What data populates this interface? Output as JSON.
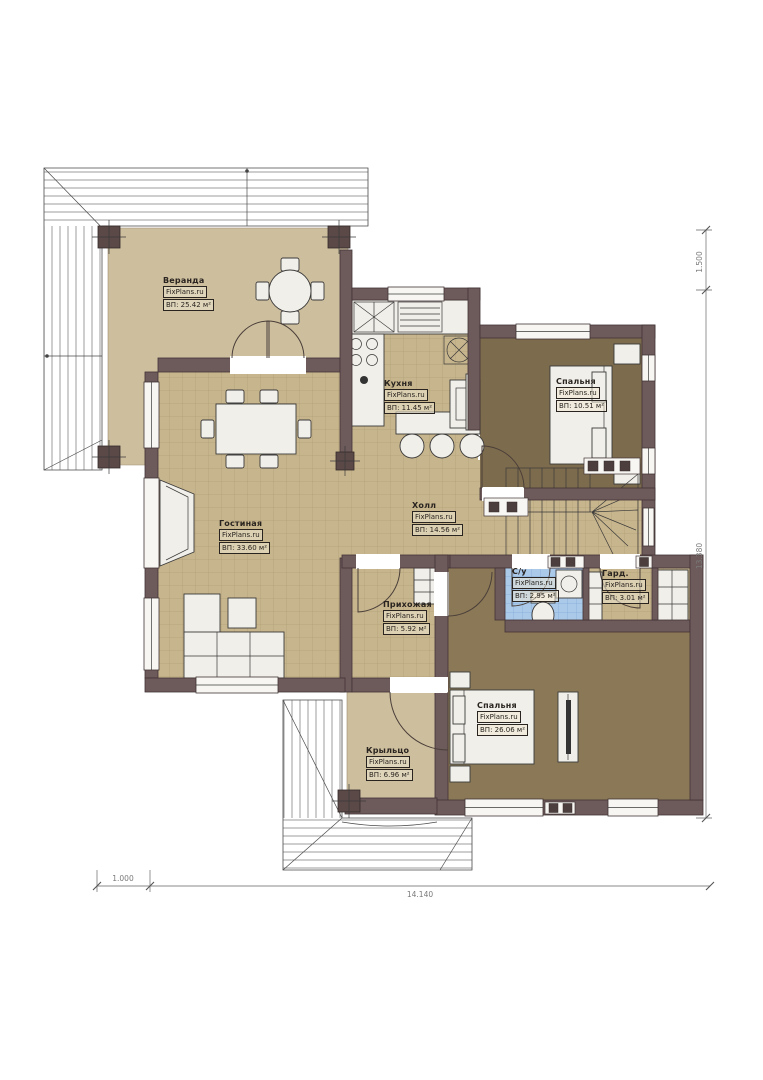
{
  "plan": {
    "brand": "FixPlans.ru",
    "rooms": [
      {
        "name": "Веранда",
        "brand": "FixPlans.ru",
        "area": "ВП: 25.42 м²"
      },
      {
        "name": "Кухня",
        "brand": "FixPlans.ru",
        "area": "ВП: 11.45 м²"
      },
      {
        "name": "Спальня",
        "brand": "FixPlans.ru",
        "area": "ВП: 10.51 м²"
      },
      {
        "name": "Холл",
        "brand": "FixPlans.ru",
        "area": "ВП: 14.56 м²"
      },
      {
        "name": "Гостиная",
        "brand": "FixPlans.ru",
        "area": "ВП: 33.60 м²"
      },
      {
        "name": "Прихожая",
        "brand": "FixPlans.ru",
        "area": "ВП: 5.92 м²"
      },
      {
        "name": "С/у",
        "brand": "FixPlans.ru",
        "area": "ВП: 2.95 м²"
      },
      {
        "name": "Гард.",
        "brand": "FixPlans.ru",
        "area": "ВП: 3.01 м²"
      },
      {
        "name": "Спальня",
        "brand": "FixPlans.ru",
        "area": "ВП: 26.06 м²"
      },
      {
        "name": "Крыльцо",
        "brand": "FixPlans.ru",
        "area": "ВП: 6.96 м²"
      }
    ],
    "dimensions": {
      "right_top": "1.500",
      "right_main": "13.380",
      "bottom_left": "1.000",
      "bottom_main": "14.140"
    },
    "colors": {
      "wall": "#6d5a5b",
      "floor_tan": "#cdbe9e",
      "floor_tile": "#c7b58d",
      "floor_wood_dark": "#7d6b4d",
      "floor_wood": "#8b7857",
      "bath_tile": "#abc9e9"
    }
  }
}
